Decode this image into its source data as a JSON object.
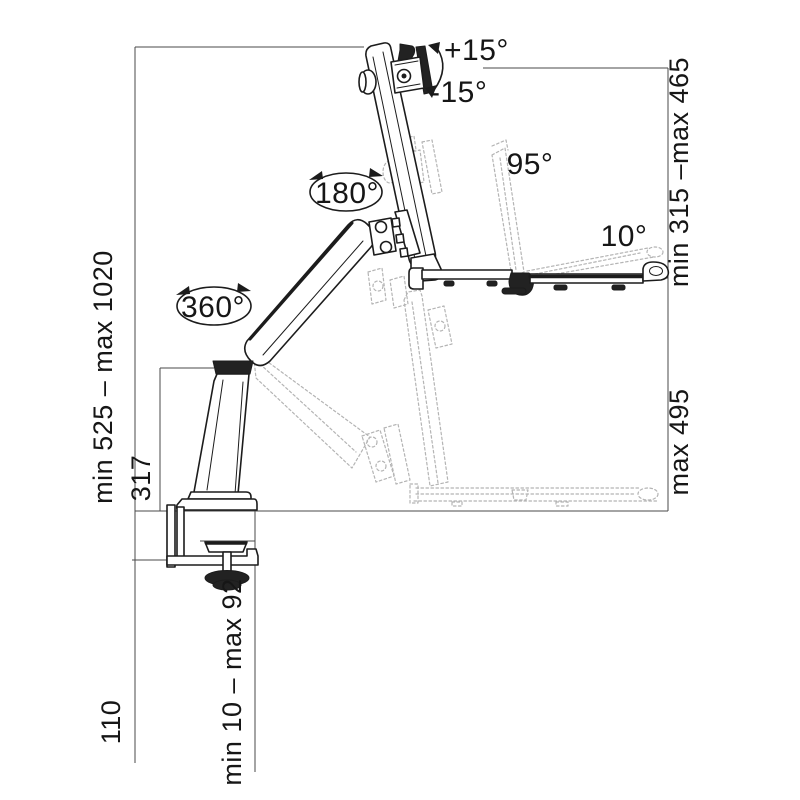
{
  "diagram": {
    "type": "technical-dimension-drawing",
    "subject": "desk-clamped sit-stand monitor arm with keyboard tray, side view with dimensions",
    "angle_annotations": {
      "monitor_tilt_up": "+15°",
      "monitor_tilt_down": "-15°",
      "arm_swivel": "180°",
      "base_rotation": "360°",
      "tray_fold": "95°",
      "tray_tilt": "10°"
    },
    "dimension_labels": {
      "overall_height": "min 525 – max 1020",
      "pole_height": "317",
      "below_desk_clearance": "110",
      "desk_clamp_range": "min 10 – max 92",
      "tray_to_monitor_height": "min 315 –max 465",
      "tray_to_desk_height": "max 495"
    },
    "colors": {
      "line": "#1c1c1c",
      "dimension_line": "#4a4a4a",
      "ghost": "#b4b4b4",
      "background": "#ffffff"
    }
  }
}
